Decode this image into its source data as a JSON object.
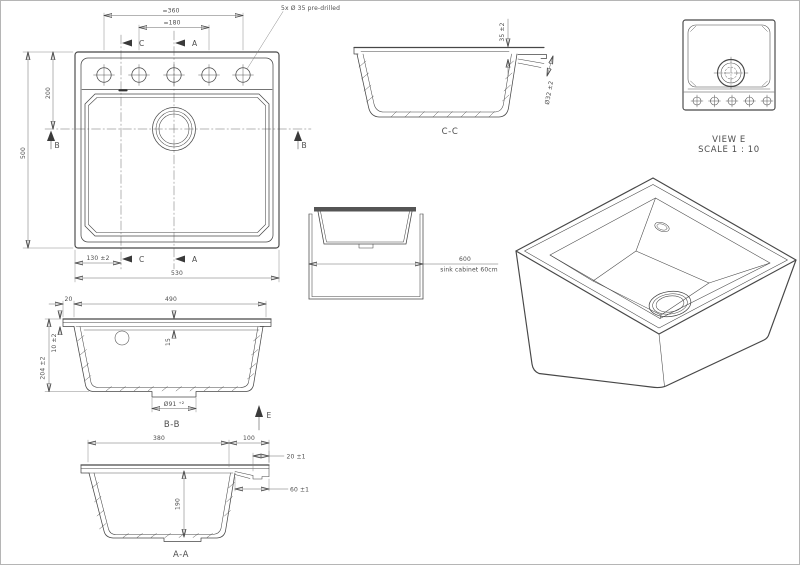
{
  "plan": {
    "dim_span_outer": "=360",
    "dim_span_inner": "=180",
    "note_predrilled": "5x Ø 35 pre-drilled",
    "dim_height": "500",
    "dim_center_offset": "200",
    "dim_left_offset": "130 ±2",
    "dim_width": "530",
    "letter_a": "A",
    "letter_b": "B",
    "letter_c": "C"
  },
  "section_cc": {
    "label": "C-C",
    "dim_overflow_depth": "35 ±2",
    "dim_overflow_diameter": "Ø32 ±2"
  },
  "view_e": {
    "label": "VIEW E",
    "scale": "SCALE 1 : 10"
  },
  "cabinet": {
    "dim_width": "600",
    "note": "sink cabinet 60cm"
  },
  "section_bb": {
    "label": "B-B",
    "dim_rim": "20",
    "dim_inner_width": "490",
    "dim_rim_height": "10 ±2",
    "dim_total_depth": "204 ±2",
    "dim_deck_depth": "15",
    "dim_drain_diameter": "Ø91 ⁺²",
    "letter_e": "E"
  },
  "section_aa": {
    "label": "A-A",
    "dim_bowl_width": "380",
    "dim_deck_width": "100",
    "dim_ledge_thickness": "20 ±1",
    "dim_ledge_depth": "60 ±1",
    "dim_bowl_depth": "190"
  }
}
